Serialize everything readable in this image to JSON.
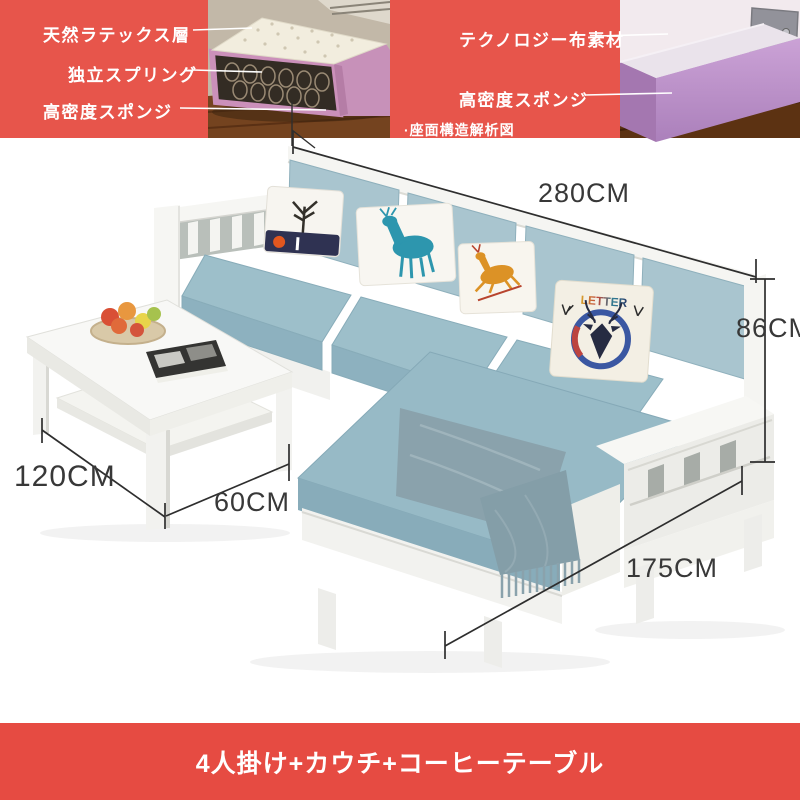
{
  "colors": {
    "accent_red": "#e7554b",
    "footer_red": "#e64b42",
    "sofa_fabric_blue": "#a9c5cf",
    "frame_white": "#f5f5f2",
    "dimension_text": "#383838",
    "label_text": "#ffffff"
  },
  "inset": {
    "caption": "·座面構造解析図",
    "left_labels": [
      "天然ラテックス層",
      "独立スプリング",
      "高密度スポンジ"
    ],
    "right_labels": [
      "テクノロジー布素材",
      "高密度スポンジ"
    ]
  },
  "dimensions": {
    "sofa_length": "280CM",
    "backrest_height": "86CM",
    "table_length": "120CM",
    "table_sofa_gap": "60CM",
    "chaise_depth": "175CM"
  },
  "pillow_print": "LETTER",
  "footer": {
    "label": "4人掛け+カウチ+コーヒーテーブル"
  }
}
